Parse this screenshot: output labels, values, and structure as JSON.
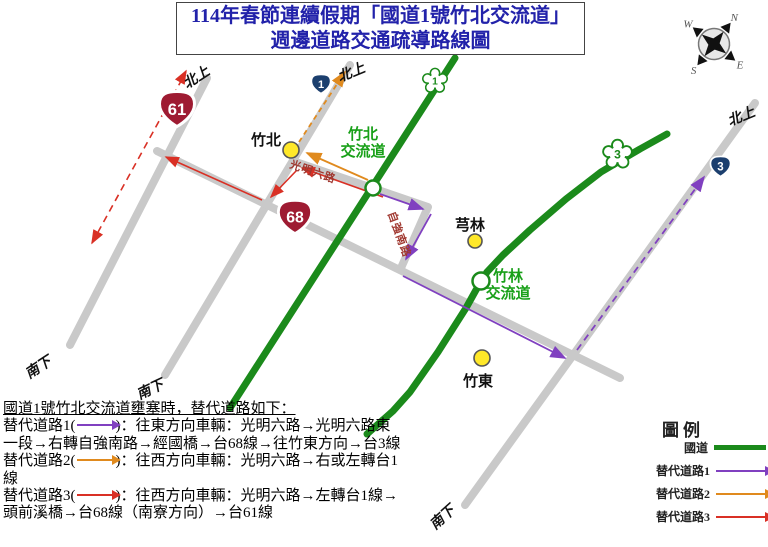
{
  "title": {
    "line1": "114年春節連續假期「國道1號竹北交流道」",
    "line2": "週邊道路交通疏導路線圖"
  },
  "compass": {
    "n": "N",
    "e": "E",
    "s": "S",
    "w": "W"
  },
  "map": {
    "shields": {
      "expressway61": "61",
      "expressway68": "68",
      "provincial1": "1",
      "provincial3": "3",
      "national1": "1",
      "national3": "3"
    },
    "labels": {
      "zhubei_town": "竹北",
      "zhubei_ic_1": "竹北",
      "zhubei_ic_2": "交流道",
      "qionglin": "芎林",
      "zhulin_ic_1": "竹林",
      "zhulin_ic_2": "交流道",
      "zhudong": "竹東",
      "guangming_rd": "光明六路",
      "ziqiang_rd": "自強南路",
      "northbound": "北上",
      "southbound": "南下"
    }
  },
  "notes": {
    "heading": "國道1號竹北交流道壅塞時，替代道路如下：",
    "routes": [
      {
        "prefix": "替代道路1(",
        "text": ")：往東方向車輛：光明六路→光明六路東一段→右轉自強南路→經國橋→台68線→往竹東方向→台3線"
      },
      {
        "prefix": "替代道路2(",
        "text": ")：往西方向車輛：光明六路→右或左轉台1線"
      },
      {
        "prefix": "替代道路3(",
        "text": ")：往西方向車輛：光明六路→左轉台1線→頭前溪橋→台68線（南寮方向）→台61線"
      }
    ]
  },
  "legend": {
    "title": "圖例",
    "items": [
      {
        "label": "國道",
        "type": "line",
        "color": "#1B8A1B"
      },
      {
        "label": "替代道路1",
        "type": "arrow",
        "color": "#8040C0"
      },
      {
        "label": "替代道路2",
        "type": "arrow",
        "color": "#E08A1E"
      },
      {
        "label": "替代道路3",
        "type": "arrow",
        "color": "#D93025"
      }
    ]
  },
  "colors": {
    "title_text": "#2222AA",
    "national_highway_green": "#1B8A1B",
    "road_gray": "#C9C9C9",
    "alt_route_1_purple": "#8040C0",
    "alt_route_2_orange": "#E08A1E",
    "alt_route_3_red": "#D93025",
    "expressway_shield_red": "#9E1B32",
    "provincial_shield_blue": "#1C3F6E",
    "town_marker_yellow": "#FFE829",
    "green_label_text": "#18A018",
    "road_name_text": "#A03830"
  }
}
